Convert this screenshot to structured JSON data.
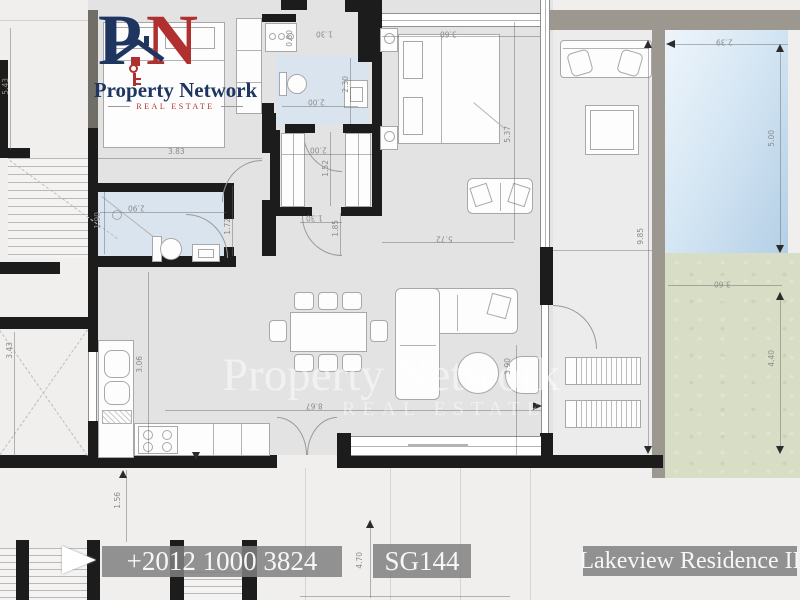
{
  "logo": {
    "monogram_p": "P",
    "monogram_n": "N",
    "name": "Property Network",
    "tagline": "REAL ESTATE"
  },
  "watermark": {
    "line1": "Property Network",
    "line2": "REAL ESTATE"
  },
  "footer": {
    "phone": "+2012 1000 3824",
    "unit_code": "SG144",
    "project": "Lakeview Residence II"
  },
  "colors": {
    "floor": "#e3e3e4",
    "bath_floor": "#d9e4ee",
    "grass": "#d8dec6",
    "pool": "#c6dcee",
    "wall": "#1c1c1c",
    "accent_navy": "#1e3560",
    "accent_red": "#b03030"
  },
  "dims": [
    "5.43",
    "3.83",
    "1.90",
    "2.90",
    "1.72",
    "0.80",
    "1.30",
    "2.30",
    "2.00",
    "2.00",
    "1.52",
    "1.85",
    "1.30",
    "3.60",
    "5.37",
    "5.72",
    "9.85",
    "2.39",
    "5.00",
    "3.60",
    "4.40",
    "8.67",
    "3.06",
    "3.90",
    "1.56",
    "4.70",
    "3.43"
  ]
}
